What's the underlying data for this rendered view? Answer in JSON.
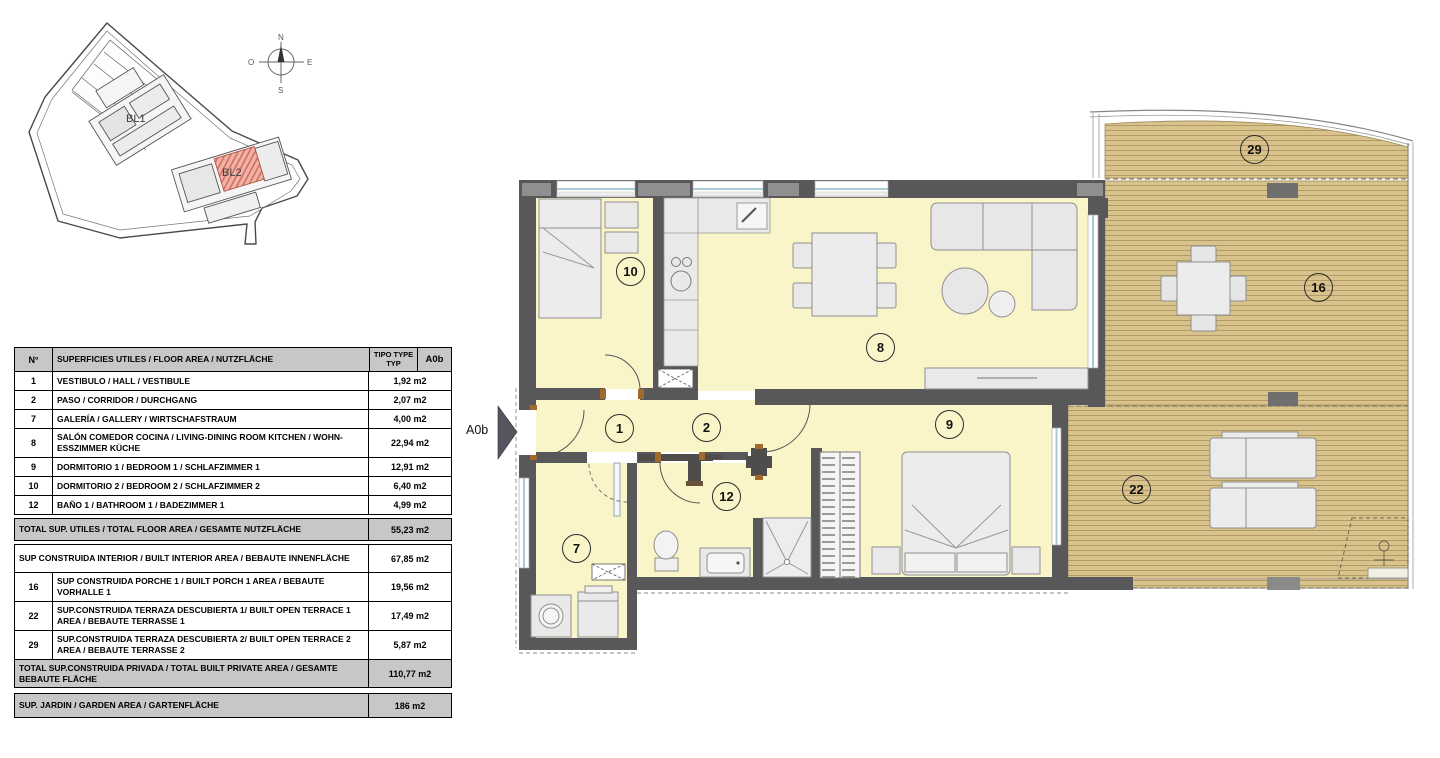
{
  "site_plan": {
    "bl1_label": "BL1",
    "bl2_label": "BL2",
    "compass": {
      "north": "N",
      "south": "S",
      "east": "E",
      "west": "O"
    }
  },
  "floor_plan": {
    "unit_arrow_label": "A0b",
    "room_numbers": {
      "hall": "1",
      "corridor": "2",
      "gallery": "7",
      "living": "8",
      "bedroom1": "9",
      "bedroom2": "10",
      "bathroom": "12",
      "porch": "16",
      "terrace1": "22",
      "terrace2": "29"
    },
    "colors": {
      "wall": "#58585a",
      "interior_floor": "#faf5c9",
      "deck": "#d9c38c",
      "highlight_unit": "#f2b3a6"
    }
  },
  "area_table": {
    "header": {
      "num": "N°",
      "desc": "SUPERFICIES UTILES / FLOOR AREA / NUTZFLÄCHE",
      "type_line1": "TIPO TYPE",
      "type_line2": "TYP",
      "unit": "A0b"
    },
    "rows": [
      {
        "num": "1",
        "desc": "VESTIBULO / HALL  / VESTIBULE",
        "value": "1,92 m2"
      },
      {
        "num": "2",
        "desc": "PASO  / CORRIDOR / DURCHGANG",
        "value": "2,07 m2"
      },
      {
        "num": "7",
        "desc": "GALERÍA / GALLERY / WIRTSCHAFSTRAUM",
        "value": "4,00 m2"
      },
      {
        "num": "8",
        "desc": "SALÓN COMEDOR COCINA / LIVING-DINING ROOM KITCHEN / WOHN-ESSZIMMER KÜCHE",
        "value": "22,94 m2"
      },
      {
        "num": "9",
        "desc": "DORMITORIO 1 / BEDROOM 1 / SCHLAFZIMMER 1",
        "value": "12,91 m2"
      },
      {
        "num": "10",
        "desc": "DORMITORIO 2 / BEDROOM 2 / SCHLAFZIMMER 2",
        "value": "6,40 m2"
      },
      {
        "num": "12",
        "desc": "BAÑO 1 / BATHROOM 1 / BADEZIMMER 1",
        "value": "4,99 m2"
      }
    ],
    "total_utiles": {
      "desc": "TOTAL SUP. UTILES / TOTAL FLOOR AREA / GESAMTE NUTZFLÄCHE",
      "value": "55,23 m2"
    },
    "built_interior": {
      "desc": "SUP CONSTRUIDA INTERIOR / BUILT INTERIOR AREA / BEBAUTE INNENFLÄCHE",
      "value": "67,85 m2"
    },
    "outdoor_rows": [
      {
        "num": "16",
        "desc": "SUP CONSTRUIDA PORCHE 1 / BUILT PORCH 1 AREA / BEBAUTE VORHALLE 1",
        "value": "19,56 m2"
      },
      {
        "num": "22",
        "desc": "SUP.CONSTRUIDA TERRAZA DESCUBIERTA 1/ BUILT OPEN TERRACE  1 AREA / BEBAUTE TERRASSE 1",
        "value": "17,49 m2"
      },
      {
        "num": "29",
        "desc": "SUP.CONSTRUIDA TERRAZA DESCUBIERTA 2/ BUILT OPEN TERRACE  2 AREA / BEBAUTE TERRASSE 2",
        "value": "5,87 m2"
      }
    ],
    "total_privada": {
      "desc": "TOTAL SUP.CONSTRUIDA PRIVADA / TOTAL  BUILT PRIVATE AREA / GESAMTE BEBAUTE FLÄCHE",
      "value": "110,77 m2"
    },
    "garden": {
      "desc": "SUP. JARDIN / GARDEN AREA / GARTENFLÄCHE",
      "value": "186 m2"
    }
  }
}
